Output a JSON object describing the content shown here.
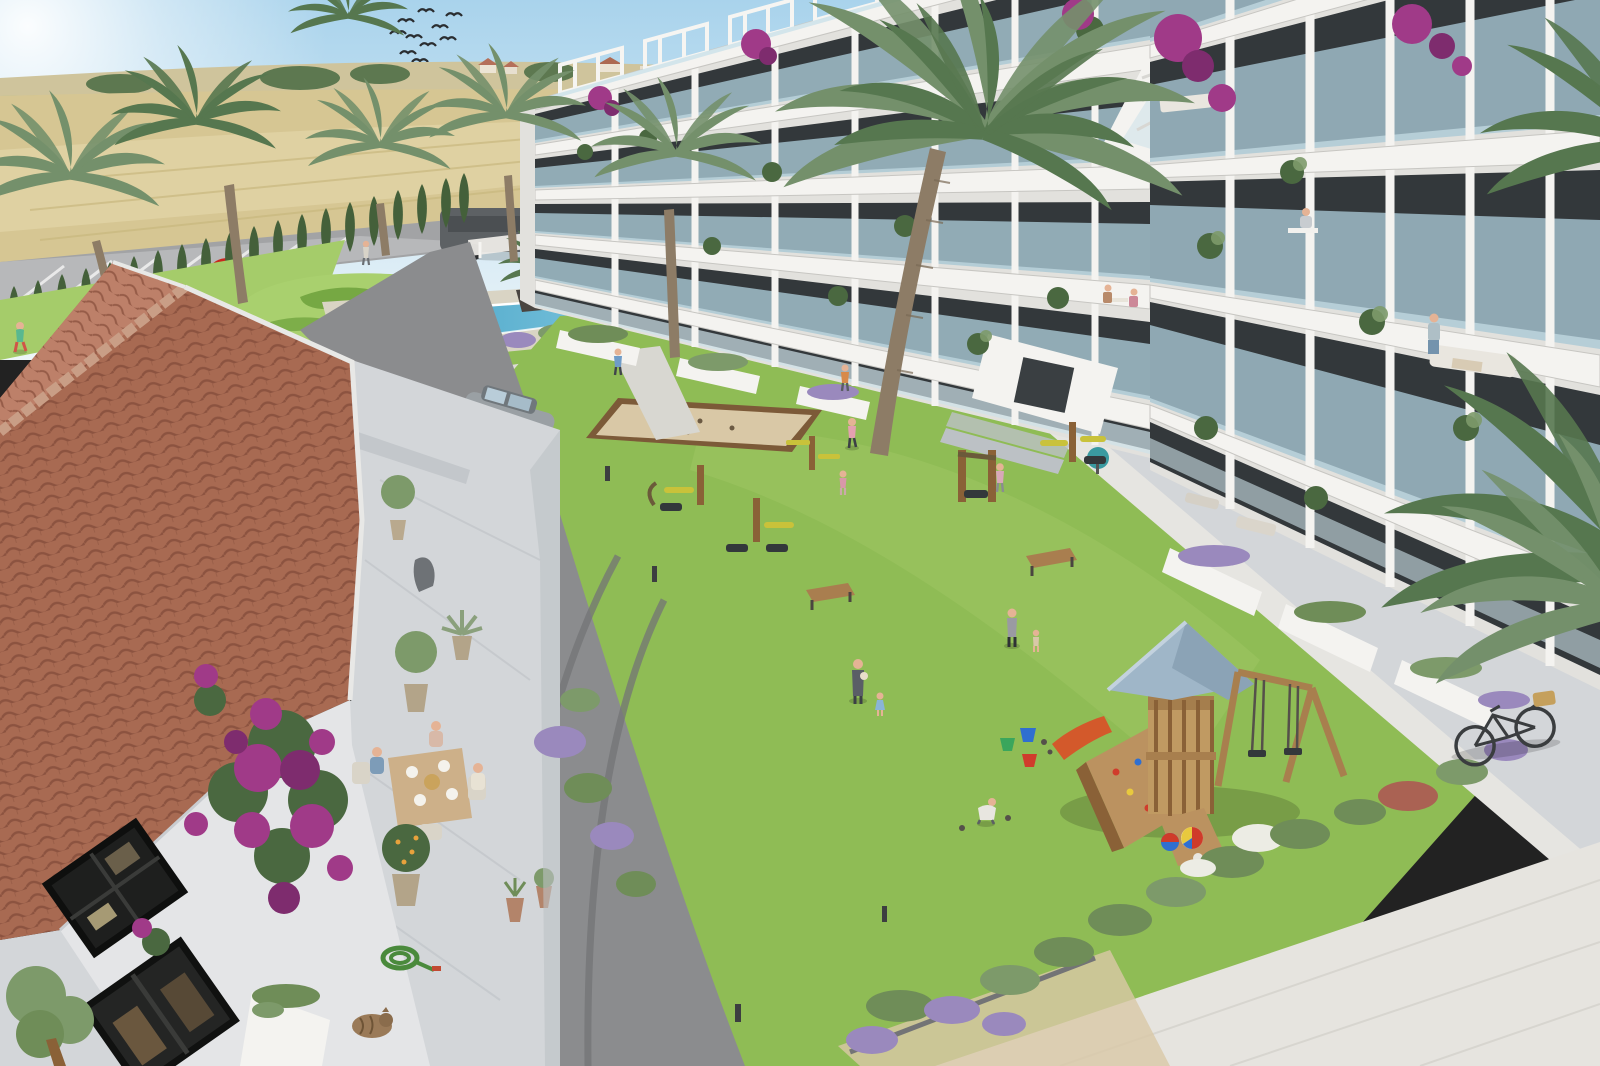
{
  "scene": {
    "type": "architectural-render",
    "description": "Aerial 3D visualization of a Mediterranean residential complex: two modern white apartment wings with glass balconies wrap a landscaped courtyard with pool, lawn, playground and an old terracotta-roofed farmhouse in the foreground",
    "sky": {
      "condition": "clear with sun glare top-left",
      "birds": "flock of 10 swallows"
    },
    "countryside": {
      "fields": "golden wheat fields on rolling hills",
      "village": "distant white houses with terracotta roofs among trees",
      "road": "country road with vehicles",
      "hedge": "row of Italian cypress along the road",
      "parking": "striped parking bays"
    },
    "vehicles": [
      {
        "type": "panel-van",
        "color": "dark-gray"
      },
      {
        "type": "delivery-box-truck",
        "color": "white",
        "logo": "orange emblem"
      },
      {
        "type": "coupe",
        "color": "red"
      },
      {
        "type": "suv",
        "color": "silver-gray"
      }
    ],
    "apartments": {
      "wings": 2,
      "style": "modern white render, staggered floors",
      "floors_visible": 5,
      "balconies": "frameless glass railings, potted plants, bougainvillea",
      "rooftop": "solarium terraces with white pergolas",
      "residents": [
        "man working at desk on balcony",
        "couple at balcony table",
        "person tending balcony plants",
        "sofas and lounge furniture"
      ]
    },
    "amenities": [
      "swimming pool with swimmers",
      "ornamental putting green",
      "petanque sand court",
      "outdoor gym equipment",
      "children playground",
      "central lawn",
      "benches",
      "path bollards"
    ],
    "playground": {
      "tower": "wooden",
      "roof": "slate-blue pitched",
      "slide": "orange",
      "swings": 2,
      "climbing_wall": "with colored holds",
      "toys": [
        "beach ball",
        "red-blue ball",
        "buckets green blue red"
      ]
    },
    "farmhouse": {
      "roof": "terracotta barrel tiles, hipped",
      "walls": "whitewashed with black-framed windows",
      "vine": "magenta bougainvillea",
      "terrace": "three people having breakfast at wooden table",
      "props": [
        "potted citrus tree",
        "coiled green garden hose",
        "sleeping tabby cat",
        "stone statue",
        "potted olive trees",
        "agave pot",
        "planter boxes"
      ]
    },
    "people_on_lawn": [
      "jogger",
      "mother holding baby",
      "toddler in blue dress",
      "woman with toddler",
      "girls in pink",
      "boy crouching with toys",
      "walkers on paths",
      "children by pool"
    ],
    "foreground": {
      "palms": 8,
      "bicycle": "city bike with basket",
      "shrubs": [
        "lavender",
        "white flowering",
        "red flowering"
      ],
      "plaza": "large pale stone pavement"
    }
  },
  "colors": {
    "sky_top": "#a9d3ec",
    "sky_horizon": "#eef6f9",
    "sun": "#ffffff",
    "hill": "#cfc49c",
    "distant_tree": "#5d7850",
    "field_tan": "#d6c693",
    "field_light": "#e3d6a8",
    "field_green": "#a9bf74",
    "road": "#a2a3a5",
    "parking": "#b7b8ba",
    "stripe": "#e9e9e9",
    "asphalt": "#8b8c8e",
    "tire": "#737476",
    "cypress": "#44603a",
    "lawn": "#8fbc55",
    "lawn_light": "#a5cc6a",
    "putting": "#a9d06e",
    "topiary": "#76a843",
    "pool_deep": "#3f9fc4",
    "pool_light": "#83c8df",
    "deck": "#d9d4c4",
    "bldg_white": "#f4f3f0",
    "bldg_shade": "#e2e1dd",
    "slab_shadow": "#c7c6c2",
    "glass": "#a9c8d5",
    "glass_light": "#cfe3ea",
    "window": "#33383b",
    "roof_tile": "#a86a52",
    "roof_line": "#8c5340",
    "roof_ridge": "#c99e86",
    "roof_light": "#bd8069",
    "terrace": "#d3d6d9",
    "step": "#bcc1c5",
    "wall_white": "#e4e5e7",
    "pavement": "#e6e4df",
    "bougainvillea": "#a03a88",
    "bougainvillea_dark": "#7e2c6e",
    "foliage": "#4a6840",
    "foliage_light": "#7d9a6a",
    "palm_frond": "#74906b",
    "palm_dark": "#56774f",
    "trunk": "#8d7c66",
    "wood": "#bb9260",
    "wood_dark": "#8a6137",
    "play_roof": "#9fb6c8",
    "slide": "#d3592b",
    "sand": "#d9c8a6",
    "sand_border": "#7c5a38",
    "lavender": "#9a89bd",
    "shrub": "#6f8d58",
    "flower_white": "#ecece4",
    "flower_red": "#aa6253",
    "skin": "#e5b395",
    "van_gray": "#5d6164",
    "truck_white": "#f1f0ec",
    "truck_logo": "#e0762a",
    "car_red": "#c8281e",
    "suv_silver": "#9aa0a4",
    "bike": "#3a3d3f",
    "basket": "#c5a05c",
    "bench": "#a97e4f",
    "bollard": "#3c3e40",
    "bucket_green": "#3aa65c",
    "bucket_blue": "#2f6fd0",
    "bucket_red": "#d03c2c",
    "ball_red": "#cf3b2a",
    "ball_blue": "#2a5fc0",
    "ball_yellow": "#e8c93e",
    "umbrella": "#3a9aa0",
    "hose": "#4a8a3c"
  }
}
